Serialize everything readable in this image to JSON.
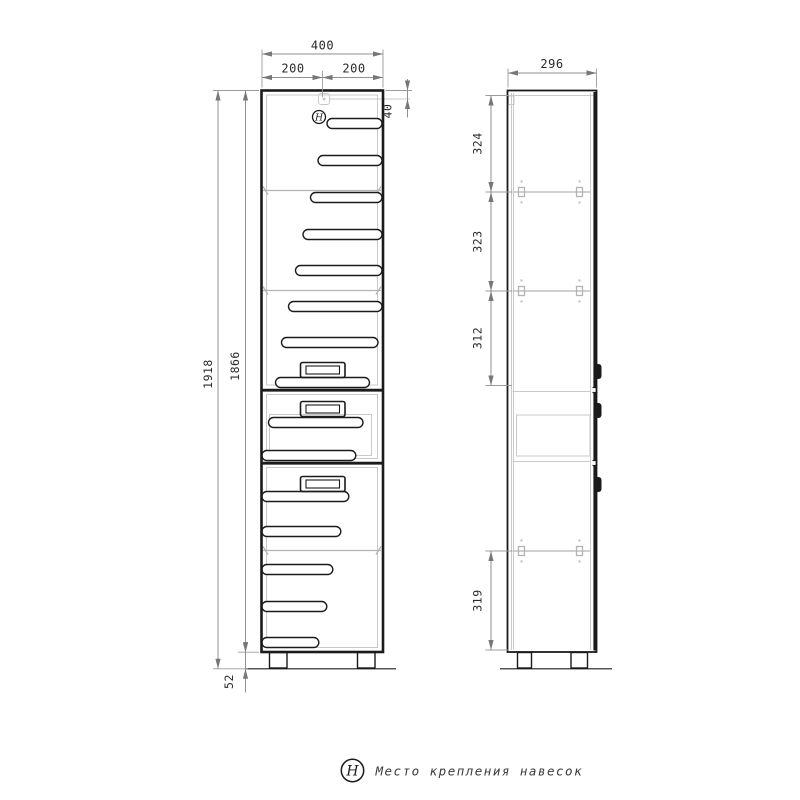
{
  "page": {
    "background": "#ffffff",
    "line_color": "#1b1b1b",
    "dim_line_color": "#8f8f8f",
    "text_color": "#2b2b2b"
  },
  "front_view": {
    "dims": {
      "total_width": "400",
      "left_half": "200",
      "right_half": "200",
      "hanger_offset": "40",
      "total_height": "1918",
      "body_height": "1866",
      "leg_height": "52"
    },
    "hanger_symbol": "Н"
  },
  "side_view": {
    "dims": {
      "depth": "296",
      "top_section": "324",
      "second_section": "323",
      "third_section": "312",
      "bottom_section": "319"
    }
  },
  "legend": {
    "symbol": "Н",
    "label": "Место крепления навесок"
  }
}
